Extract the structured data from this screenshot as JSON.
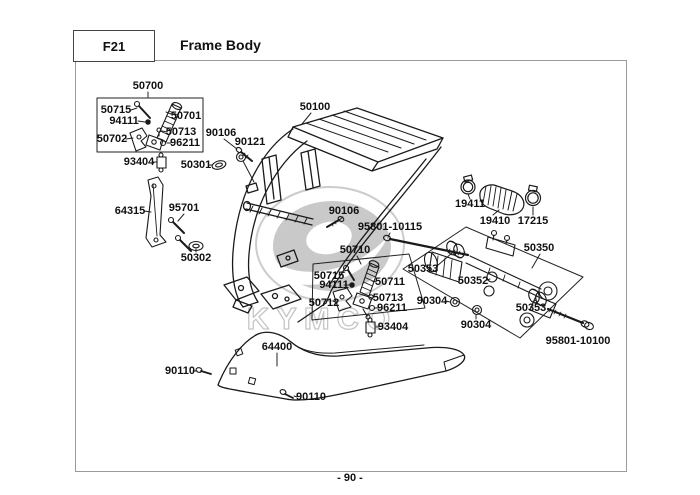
{
  "header": {
    "section_code": "F21",
    "title": "Frame Body"
  },
  "footer": {
    "page_number": "- 90 -"
  },
  "watermark": {
    "brand": "KYMCO"
  },
  "colors": {
    "line": "#1a1a1a",
    "border_gray": "#9a9a9a",
    "watermark_gray": "#c9c9c9"
  },
  "diagram": {
    "labels": [
      {
        "text": "50700"
      },
      {
        "text": "50715"
      },
      {
        "text": "94111"
      },
      {
        "text": "50701"
      },
      {
        "text": "50702"
      },
      {
        "text": "50713"
      },
      {
        "text": "96211"
      },
      {
        "text": "93404"
      },
      {
        "text": "50301"
      },
      {
        "text": "90106"
      },
      {
        "text": "90121"
      },
      {
        "text": "50100"
      },
      {
        "text": "64315"
      },
      {
        "text": "95701"
      },
      {
        "text": "50302"
      },
      {
        "text": "90106"
      },
      {
        "text": "95801-10115"
      },
      {
        "text": "19411"
      },
      {
        "text": "19410"
      },
      {
        "text": "17215"
      },
      {
        "text": "50350"
      },
      {
        "text": "50710"
      },
      {
        "text": "50715"
      },
      {
        "text": "94111"
      },
      {
        "text": "50711"
      },
      {
        "text": "50712"
      },
      {
        "text": "50713"
      },
      {
        "text": "96211"
      },
      {
        "text": "50353"
      },
      {
        "text": "50352"
      },
      {
        "text": "90304"
      },
      {
        "text": "90304"
      },
      {
        "text": "50353"
      },
      {
        "text": "95801-10100"
      },
      {
        "text": "93404"
      },
      {
        "text": "64400"
      },
      {
        "text": "90110"
      },
      {
        "text": "90110"
      }
    ]
  }
}
